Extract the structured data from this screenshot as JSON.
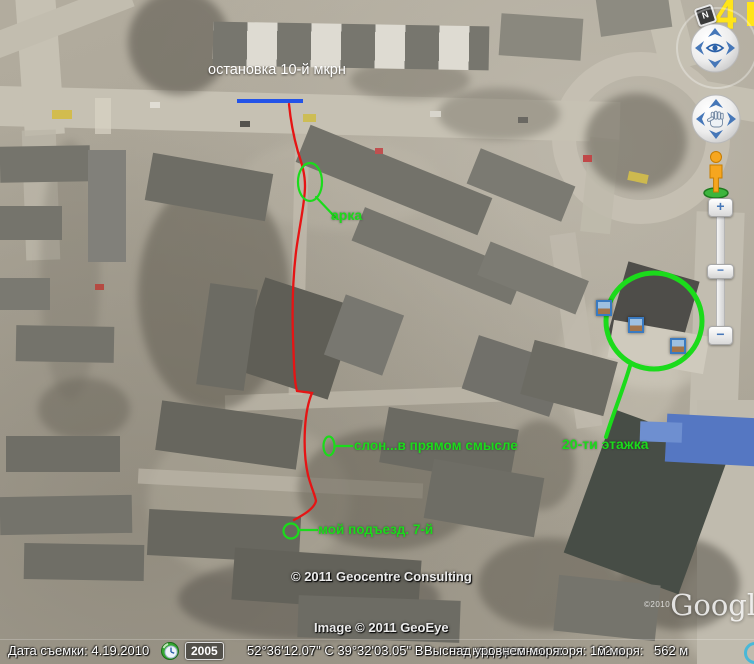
{
  "map_labels": {
    "bus_stop": "остановка 10-й мкрн",
    "arch": "арка",
    "elephant": "слон...в прямом смысле",
    "entrance": "мой подъезд. 7-й",
    "tower": "20-ти этажка"
  },
  "marker_overlay": {
    "digit": "4"
  },
  "compass": {
    "label": "N"
  },
  "zoom_slider": {
    "zoom_in": "+",
    "zoom_out": "−",
    "thumb": "−"
  },
  "icons": {
    "navigation": [
      "compass-n-icon",
      "look-joystick-eye-icon",
      "move-joystick-hand-icon",
      "pegman-icon",
      "photo-icon",
      "streaming-indicator-icon",
      "clock-icon"
    ]
  },
  "copyright": {
    "geocentre": "© 2011 Geocentre Consulting",
    "geoeye": "Image © 2011 GeoEye",
    "google_year": "©2010",
    "google_logo": "Google"
  },
  "statusbar": {
    "date_label": "Дата съемки:",
    "date_value": "4.19.2010",
    "year_badge": "2005",
    "coordinates": "52°36'12.07\" С   39°32'03.05\" В",
    "elevation_text": "Высота над уровнем моря: 162 м",
    "elevation_ghost": "над уровнем моря:",
    "elevation_ghost2": "м моря:",
    "eye_altitude": "562 м"
  },
  "colors": {
    "annotation_green": "#1bdb1b",
    "route_red": "#e61414",
    "bus_stop_blue": "#2353e8",
    "marker_yellow": "#ffe419",
    "control_blue": "#4677b8"
  }
}
